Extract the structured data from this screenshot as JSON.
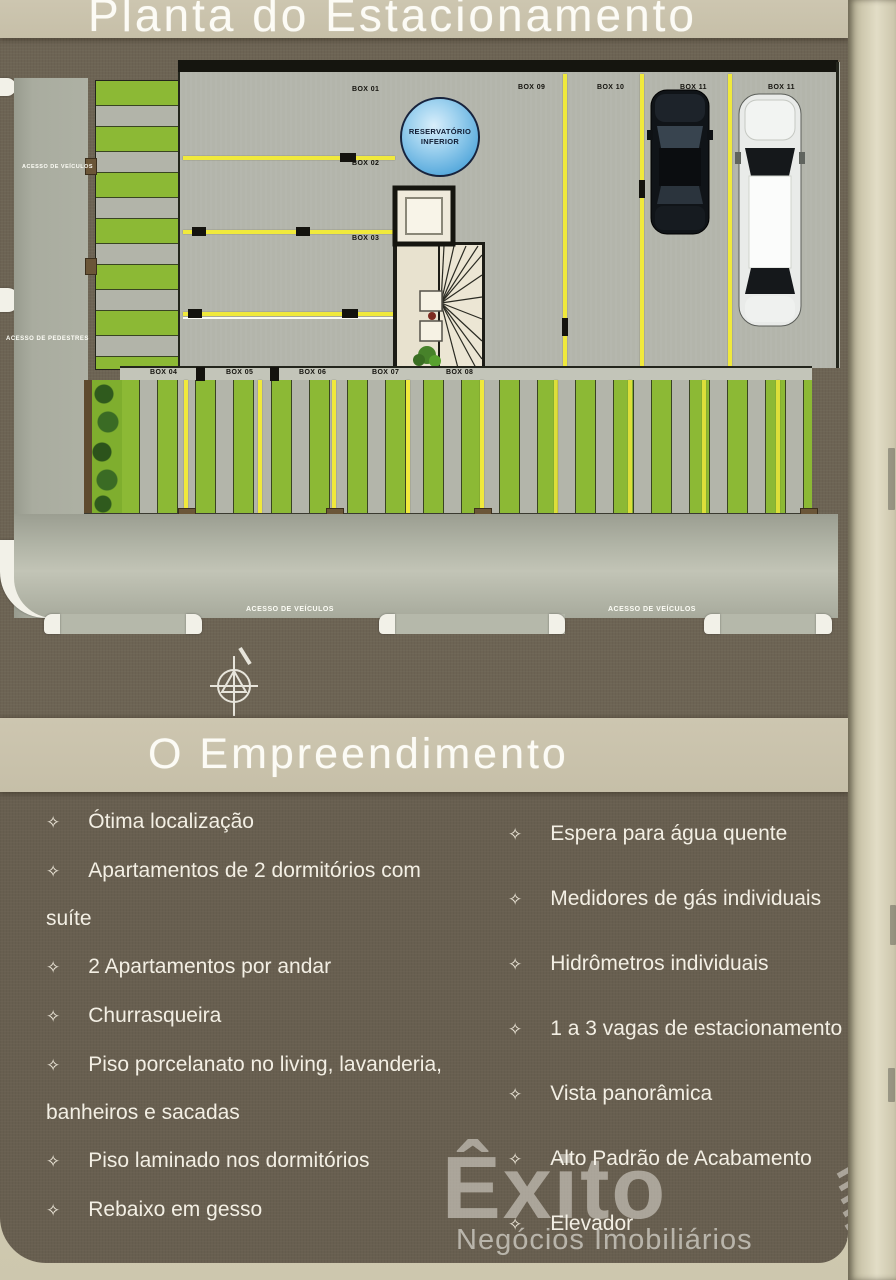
{
  "titles": {
    "main": "Planta do Estacionamento",
    "section": "O Empreendimento"
  },
  "plan": {
    "reservoir": {
      "line1": "RESERVATÓRIO",
      "line2": "INFERIOR"
    },
    "access": {
      "vehicles_side": "ACESSO DE VEÍCULOS",
      "pedestrians": "ACESSO DE PEDESTRES",
      "vehicles_bottom_left": "ACESSO DE VEÍCULOS",
      "vehicles_bottom_right": "ACESSO DE VEÍCULOS"
    },
    "boxes": {
      "b01": "BOX 01",
      "b02": "BOX 02",
      "b03": "BOX 03",
      "b04": "BOX 04",
      "b05": "BOX 05",
      "b06": "BOX 06",
      "b07": "BOX 07",
      "b08": "BOX 08",
      "b09": "BOX 09",
      "b10": "BOX 10",
      "b11a": "BOX 11",
      "b11b": "BOX 11"
    }
  },
  "features": {
    "bullet": "✧",
    "left": [
      "Ótima localização",
      "Apartamentos de 2 dormitórios com suíte",
      "2 Apartamentos por andar",
      "Churrasqueira",
      "Piso porcelanato no living, lavanderia, banheiros e sacadas",
      "Piso laminado nos dormitórios",
      "Rebaixo em gesso"
    ],
    "right": [
      "Espera para água quente",
      "Medidores de gás individuais",
      "Hidrômetros individuais",
      "1 a 3 vagas de estacionamento",
      "Vista panorâmica",
      "Alto Padrão de Acabamento",
      "Elevador"
    ]
  },
  "logo": {
    "name": "Êxito",
    "tagline": "Negócios Imobiliários"
  },
  "colors": {
    "panel_brown": "#6d6454",
    "band_beige": "#c6bfa8",
    "stripe_green": "#8cb935",
    "line_yellow": "#f0e93c",
    "reservoir_blue": "#5aabdd"
  }
}
